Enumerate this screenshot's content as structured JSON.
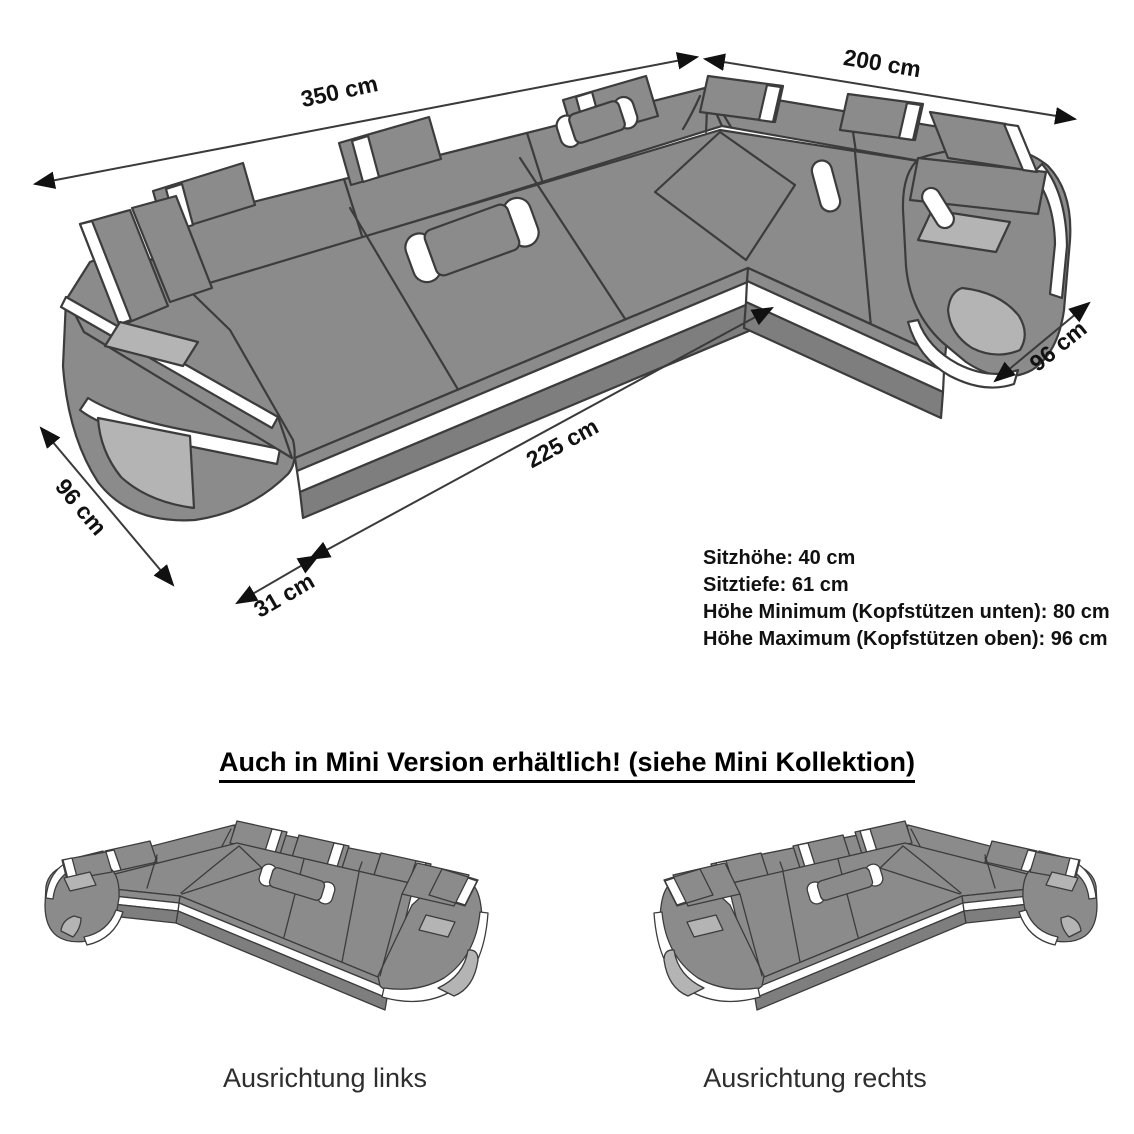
{
  "page": {
    "background_color": "#ffffff"
  },
  "main_diagram": {
    "dimensions": [
      {
        "id": "back-total-width",
        "label": "350 cm"
      },
      {
        "id": "side-back-width",
        "label": "200 cm"
      },
      {
        "id": "side-depth",
        "label": "96 cm"
      },
      {
        "id": "seat-front-width",
        "label": "225 cm"
      },
      {
        "id": "sofa-depth",
        "label": "96 cm"
      },
      {
        "id": "armrest-width",
        "label": "31 cm"
      }
    ],
    "specs": [
      "Sitzhöhe: 40 cm",
      "Sitztiefe: 61 cm",
      "Höhe Minimum (Kopfstützen unten): 80 cm",
      "Höhe Maximum (Kopfstützen oben): 96 cm"
    ]
  },
  "mini_section": {
    "heading": "Auch in Mini Version erhältlich! (siehe Mini Kollektion)",
    "variants": [
      {
        "caption": "Ausrichtung links"
      },
      {
        "caption": "Ausrichtung rechts"
      }
    ]
  },
  "illustration_colors": {
    "body": "#8b8b8b",
    "outline": "#3c3c3c",
    "accent_stripe": "#ffffff",
    "panel": "#b4b4b4",
    "plinth": "#7e7e7e",
    "dimension_text": "#111111"
  }
}
